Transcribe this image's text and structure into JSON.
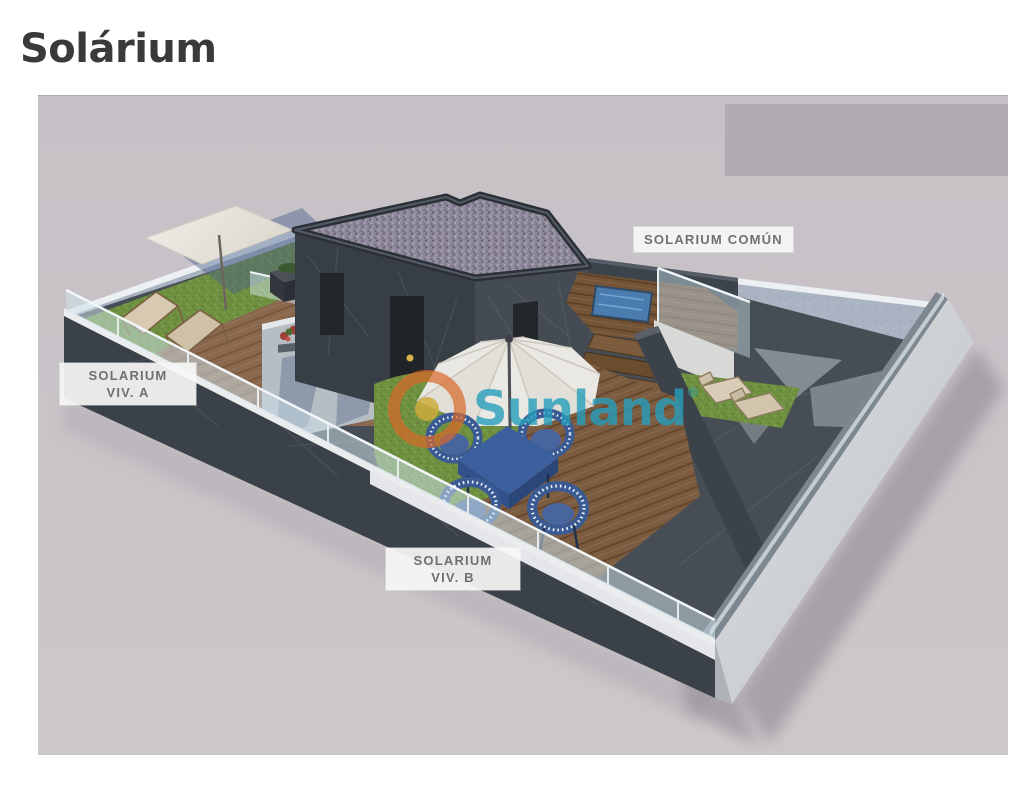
{
  "page": {
    "title": "Solárium"
  },
  "figure": {
    "labels": {
      "comun": {
        "text": "SOLARIUM COMÚN"
      },
      "viv_a": {
        "line1": "SOLARIUM",
        "line2": "VIV. A"
      },
      "viv_b": {
        "line1": "SOLARIUM",
        "line2": "VIV. B"
      }
    },
    "watermark": {
      "brand": "Sunland",
      "mark": "®"
    },
    "colors": {
      "title_text": "#3a3a3c",
      "figure_background": "#c8c3c8",
      "masked_block": "#b1acb3",
      "label_text": "#6e7173",
      "label_background": "#f6f6f6",
      "watermark_teal": "#269ebc",
      "watermark_ring_orange": "#d9682a",
      "watermark_core_yellow": "#cdac3c",
      "pool_water": "#4a7cb0",
      "grass_green": "#6e9040",
      "wood_deck_brown": "#7c5c40",
      "dark_stone": "#3b4148",
      "light_wall_blue_gray": "#a8b2c1"
    }
  }
}
